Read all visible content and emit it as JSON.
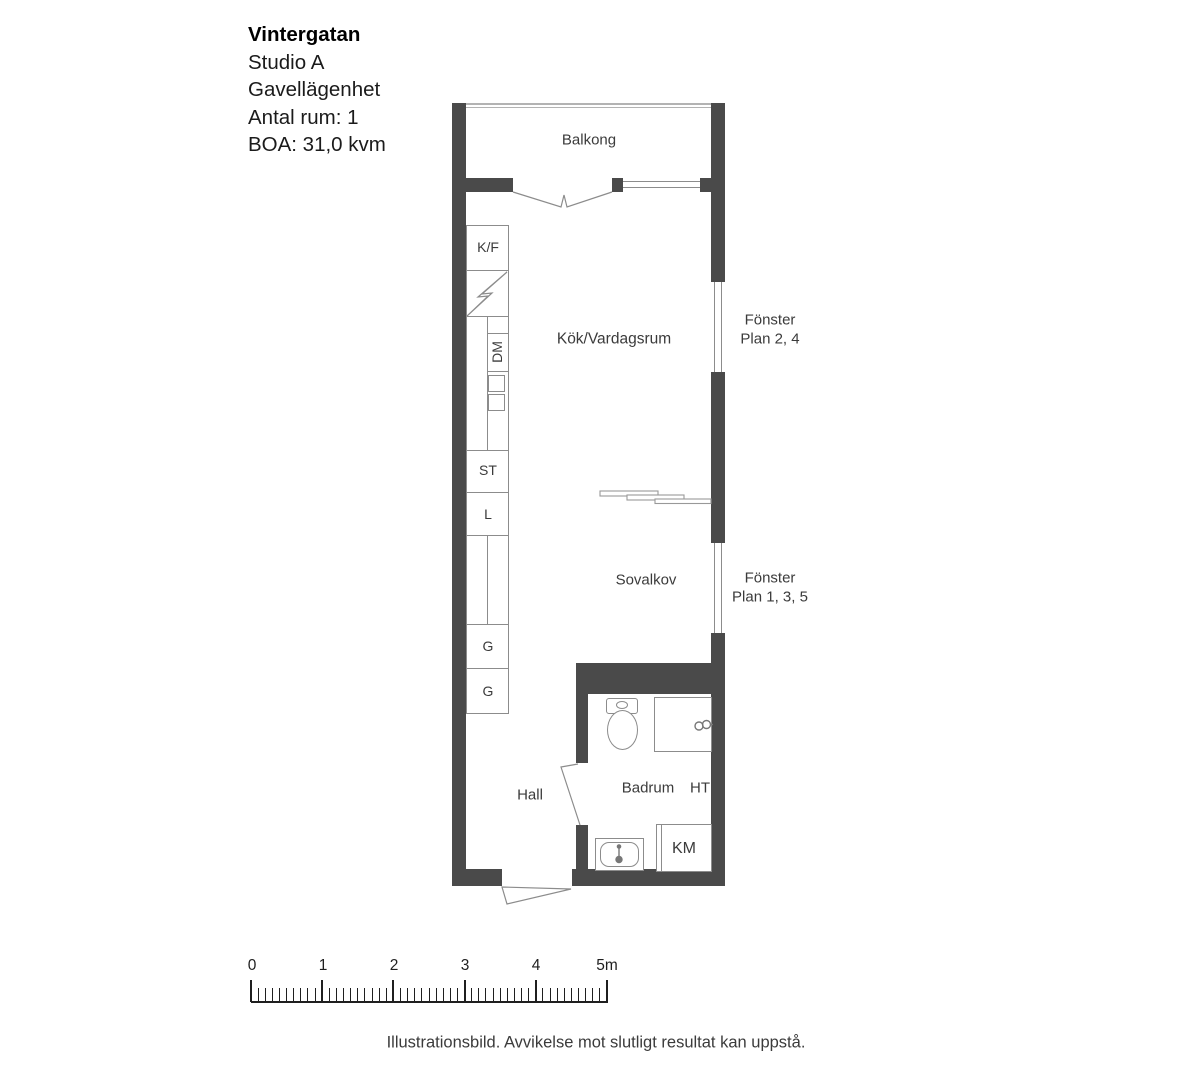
{
  "title_block": {
    "project": "Vintergatan",
    "unit": "Studio A",
    "type": "Gavellägenhet",
    "rooms": "Antal rum: 1",
    "area": "BOA: 31,0 kvm"
  },
  "room_labels": {
    "balcony": "Balkong",
    "kitchen_living": "Kök/Vardagsrum",
    "sleeping_alcove": "Sovalkov",
    "hall": "Hall",
    "bathroom": "Badrum"
  },
  "fixture_labels": {
    "fridge_freezer": "K/F",
    "dishwasher": "DM",
    "cleaning_cabinet": "ST",
    "linen_cabinet": "L",
    "wardrobe_1": "G",
    "wardrobe_2": "G",
    "towel_dryer": "HT",
    "washing_machine": "KM"
  },
  "window_labels": {
    "upper": {
      "line1": "Fönster",
      "line2": "Plan 2, 4"
    },
    "lower": {
      "line1": "Fönster",
      "line2": "Plan 1, 3, 5"
    }
  },
  "scale_bar": {
    "labels": [
      "0",
      "1",
      "2",
      "3",
      "4",
      "5m"
    ]
  },
  "footer": {
    "disclaimer": "Illustrationsbild. Avvikelse mot slutligt resultat kan uppstå."
  },
  "colors": {
    "wall": "#4a4a4a",
    "fixture_outline": "#8c8c8c",
    "text": "#3b3b3b",
    "railing": "#b3b3b3"
  }
}
